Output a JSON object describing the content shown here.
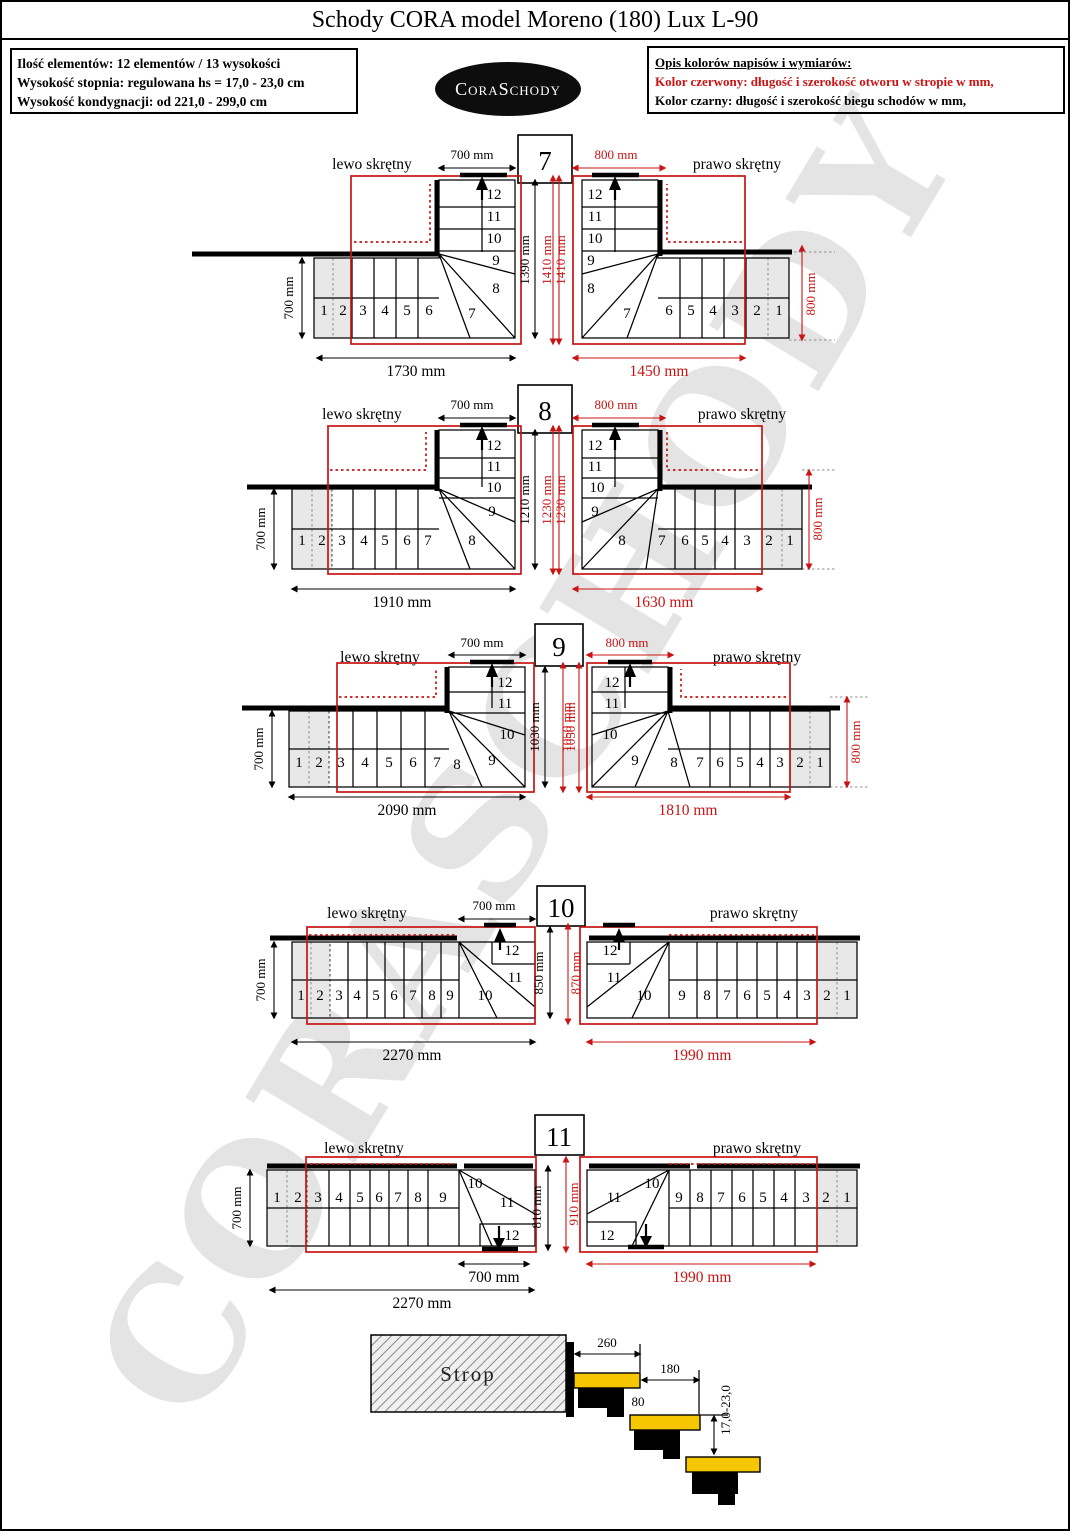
{
  "page": {
    "title": "Schody CORA model Moreno (180) Lux L-90"
  },
  "info": {
    "l1": "Ilość elementów: 12 elementów / 13 wysokości",
    "l2": "Wysokość stopnia: regulowana  hs = 17,0 - 23,0 cm",
    "l3": "Wysokość kondygnacji: od 221,0 - 299,0 cm"
  },
  "logo": "CoraSchody",
  "legend": {
    "h": "Opis kolorów napisów i wymiarów:",
    "red": "Kolor czerwony:  długość i szerokość otworu w stropie w mm,",
    "black": "Kolor czarny:  długość i szerokość biegu schodów w mm,"
  },
  "watermark": "CORASCHODY",
  "colors": {
    "dim_red": "#c81414",
    "dim_black": "#000000",
    "tread_yellow": "#f6c700",
    "entry_gray": "#e8e8e8"
  },
  "steps": [
    "1",
    "2",
    "3",
    "4",
    "5",
    "6",
    "7",
    "8",
    "9",
    "10",
    "11",
    "12"
  ],
  "rows": [
    {
      "n": "7",
      "left": {
        "label": "lewo skrętny",
        "top": "700 mm",
        "side": "700 mm",
        "hblack": "1390 mm",
        "hred": "1410 mm",
        "bottom": "1730 mm"
      },
      "right": {
        "label": "prawo skrętny",
        "top": "800 mm",
        "hred": "1410 mm",
        "bottom": "1450 mm",
        "side": "800 mm"
      }
    },
    {
      "n": "8",
      "left": {
        "label": "lewo skrętny",
        "top": "700 mm",
        "side": "700 mm",
        "hblack": "1210 mm",
        "hred": "1230 mm",
        "bottom": "1910 mm"
      },
      "right": {
        "label": "prawo skrętny",
        "top": "800 mm",
        "hred": "1230 mm",
        "bottom": "1630 mm",
        "side": "800 mm"
      }
    },
    {
      "n": "9",
      "left": {
        "label": "lewo skrętny",
        "top": "700 mm",
        "side": "700 mm",
        "hblack": "1030 mm",
        "hred": "1050 mm",
        "bottom": "2090 mm"
      },
      "right": {
        "label": "prawo skrętny",
        "top": "800 mm",
        "hred": "1050 mm",
        "bottom": "1810 mm",
        "side": "800 mm"
      }
    },
    {
      "n": "10",
      "left": {
        "label": "lewo skrętny",
        "top": "700 mm",
        "side": "700 mm",
        "hblack": "850 mm",
        "bottom": "2270 mm"
      },
      "right": {
        "label": "prawo skrętny",
        "hred": "870 mm",
        "bottom": "1990 mm"
      }
    },
    {
      "n": "11",
      "left": {
        "label": "lewo skrętny",
        "side": "700 mm",
        "hblack": "810 mm",
        "turn_bottom": "700 mm",
        "bottom": "2270 mm"
      },
      "right": {
        "label": "prawo skrętny",
        "hred": "910 mm",
        "bottom": "1990 mm"
      }
    }
  ],
  "section": {
    "strop": "Strop",
    "tread_depth": "260",
    "going": "180",
    "nose": "80",
    "riser_range": "17,0-23,0"
  }
}
